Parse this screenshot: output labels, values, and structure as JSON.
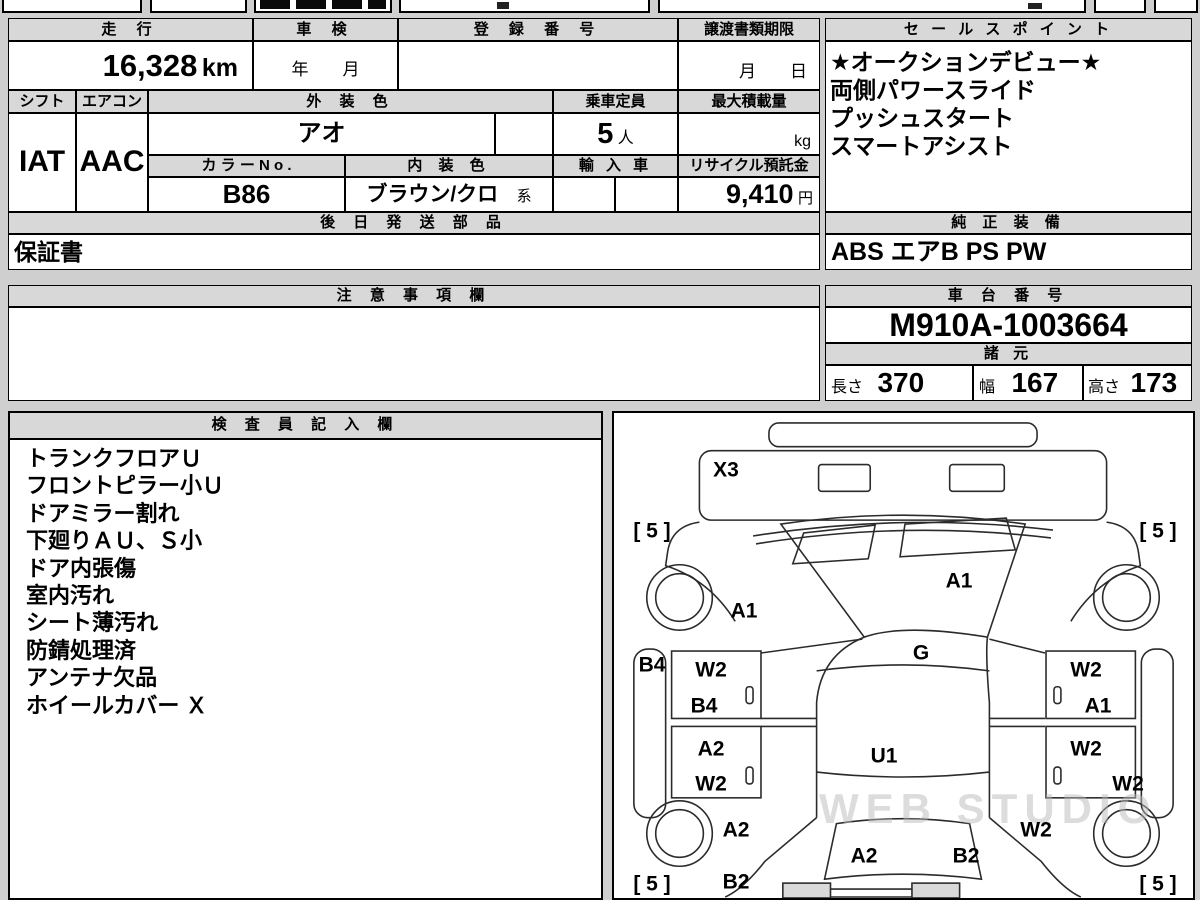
{
  "vehicle_table": {
    "mileage_label": "走 行",
    "mileage_value": "16,328",
    "mileage_unit": "km",
    "shaken_label": "車 検",
    "shaken_value": "年　　月",
    "registration_label": "登 録 番 号",
    "registration_value": "",
    "transfer_label": "譲渡書類期限",
    "transfer_value": "月　　日",
    "shift_label": "シフト",
    "shift_value": "IAT",
    "aircon_label": "エアコン",
    "aircon_value": "AAC",
    "ext_color_label": "外 装 色",
    "ext_color_value": "アオ",
    "capacity_label": "乗車定員",
    "capacity_value": "5",
    "capacity_unit": "人",
    "max_load_label": "最大積載量",
    "max_load_value": "",
    "max_load_unit": "kg",
    "color_no_label": "カ ラ ー N o .",
    "color_no_value": "B86",
    "int_color_label": "内 装 色",
    "int_color_value": "ブラウン/クロ",
    "int_color_suffix": "系",
    "import_label": "輸 入 車",
    "import_value": "",
    "recycle_label": "リサイクル預託金",
    "recycle_value": "9,410",
    "recycle_unit": "円"
  },
  "sales_points": {
    "title": "セ ー ル ス ポ イ ン ト",
    "lines": [
      "★オークションデビュー★",
      "両側パワースライド",
      "プッシュスタート",
      "スマートアシスト"
    ]
  },
  "later_parts": {
    "title": "後 日 発 送 部 品",
    "value": "保証書"
  },
  "equipment": {
    "title": "純 正 装 備",
    "value": "ABS エアB PS PW"
  },
  "cautions": {
    "title": "注 意 事 項 欄",
    "value": ""
  },
  "chassis": {
    "title": "車 台 番 号",
    "value": "M910A-1003664"
  },
  "dimensions": {
    "title": "諸 元",
    "length_label": "長さ",
    "length_value": "370",
    "width_label": "幅",
    "width_value": "167",
    "height_label": "高さ",
    "height_value": "173"
  },
  "inspector": {
    "title": "検 査 員 記 入 欄",
    "items": [
      "トランクフロアＵ",
      "フロントピラー小Ｕ",
      "ドアミラー割れ",
      "下廻りＡＵ、Ｓ小",
      "ドア内張傷",
      "室内汚れ",
      "シート薄汚れ",
      "防錆処理済",
      "アンテナ欠品",
      "ホイールカバー Ｘ"
    ]
  },
  "diagram": {
    "watermark": "WEB STUDIO",
    "labels": [
      {
        "text": "X3"
      },
      {
        "text": "[ 5 ]"
      },
      {
        "text": "[ 5 ]"
      },
      {
        "text": "A1"
      },
      {
        "text": "A1"
      },
      {
        "text": "B4"
      },
      {
        "text": "W2"
      },
      {
        "text": "B4"
      },
      {
        "text": "G"
      },
      {
        "text": "W2"
      },
      {
        "text": "A1"
      },
      {
        "text": "A2"
      },
      {
        "text": "W2"
      },
      {
        "text": "U1"
      },
      {
        "text": "W2"
      },
      {
        "text": "W2"
      },
      {
        "text": "A2"
      },
      {
        "text": "B2"
      },
      {
        "text": "A2"
      },
      {
        "text": "B2"
      },
      {
        "text": "W2"
      },
      {
        "text": "[ 5 ]"
      },
      {
        "text": "[ 5 ]"
      }
    ]
  }
}
